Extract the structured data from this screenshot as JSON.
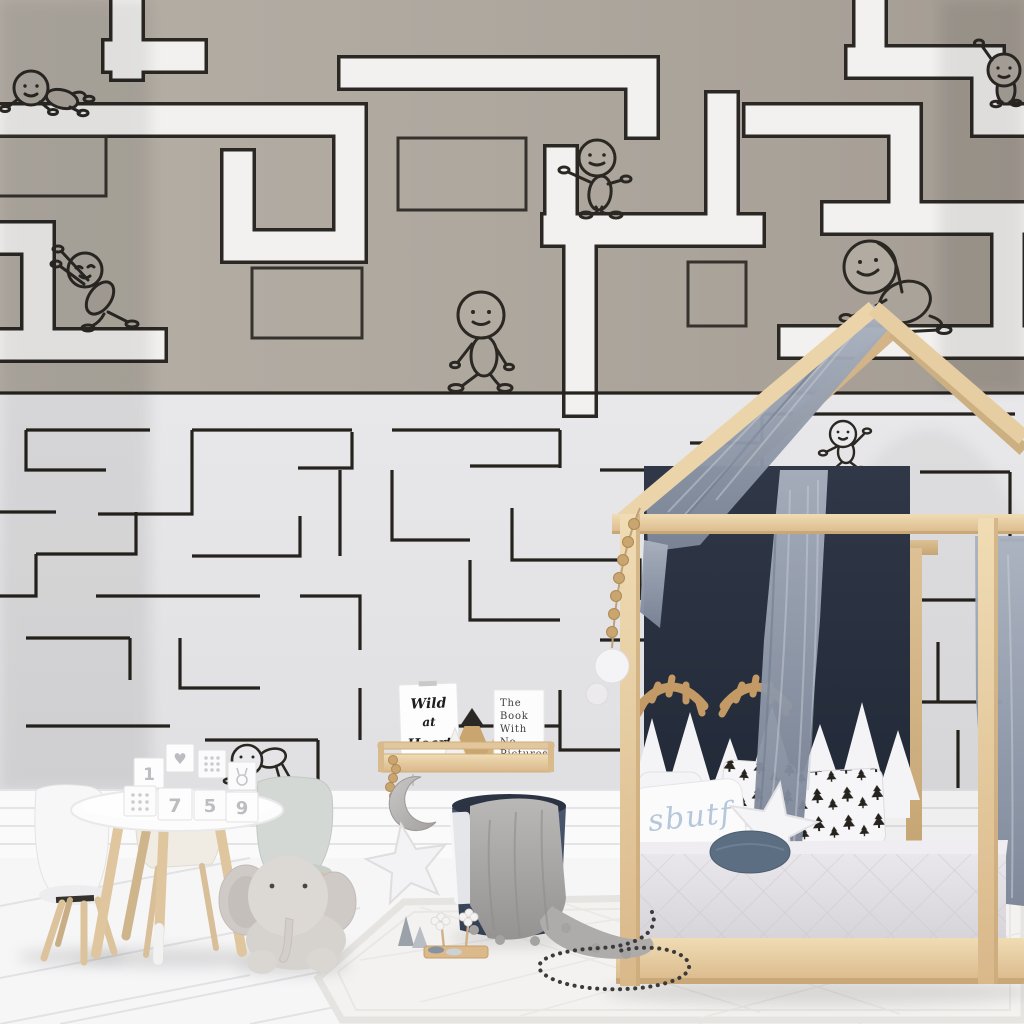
{
  "wallpaper": {
    "top_background": "#ada79e",
    "top_path_fill": "#f2f1ef",
    "outline_color": "#2b2824",
    "bottom_background": "#e5e5e7",
    "bottom_line_color": "#26231f",
    "figures": [
      "crawling-top-left",
      "leaning-left",
      "standing-top-center",
      "walking-center",
      "sitting-right",
      "waving-top-right",
      "dancing-mid-right",
      "crawling-bottom-left"
    ]
  },
  "shelf": {
    "card_lines": [
      "Wild",
      "at",
      "Heart"
    ],
    "book_lines": [
      "The",
      "Book",
      "With",
      "No",
      "Pictures"
    ],
    "wood_color": "#d9ba8b"
  },
  "bed": {
    "pillow_script": "sbutf",
    "script_color": "#b5c7da",
    "frame_color": "#e7cda2",
    "headboard_color": "#2a3140",
    "canopy_color": "#97a0b0",
    "mattress_color": "#e2dfe4",
    "round_pillow_color": "#5b6e82"
  },
  "table": {
    "block_faces": [
      "1",
      "7",
      "5",
      "9",
      "♥"
    ],
    "top_color": "#fcfcfd",
    "leg_color": "#dfc69f"
  },
  "toys": {
    "elephant_color": "#d6d2ce",
    "blanket_color": "#aaa8a7",
    "basket_color": "#3f4c62",
    "moon_color": "#b5b3b2",
    "star_color": "#f3f2f4"
  },
  "room": {
    "rug_color": "#f4f3f1",
    "floor_color": "#f6f6f7"
  }
}
